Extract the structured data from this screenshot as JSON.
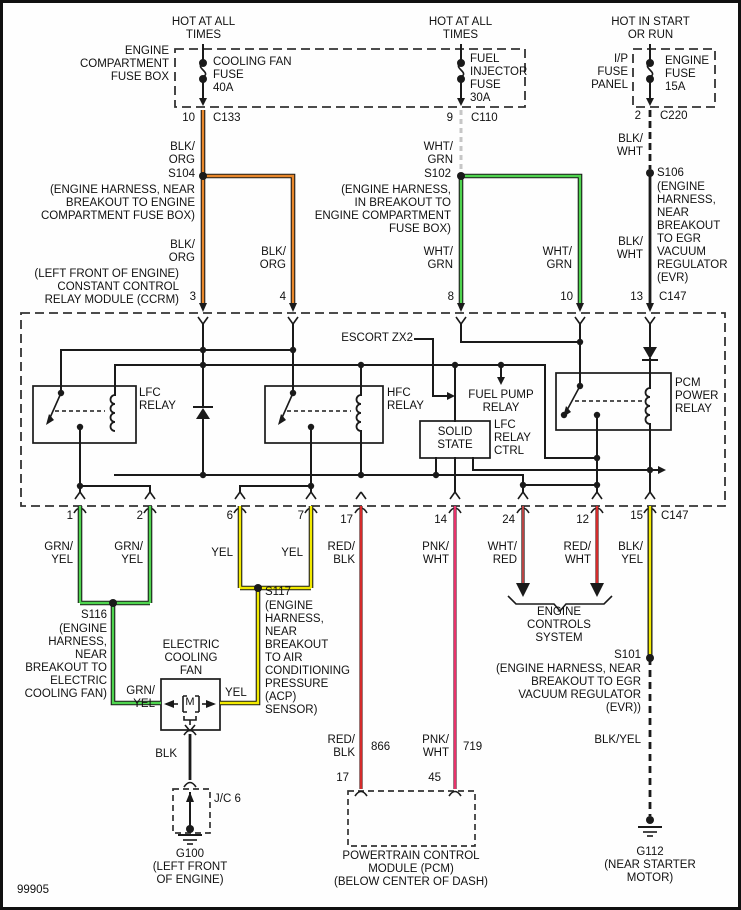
{
  "meta": {
    "footer_code": "99905"
  },
  "power": {
    "left": {
      "heading": "HOT AT ALL\nTIMES",
      "box": "ENGINE\nCOMPARTMENT\nFUSE BOX",
      "fuse": "COOLING FAN\nFUSE\n40A",
      "pin": "10",
      "conn": "C133"
    },
    "mid": {
      "heading": "HOT AT ALL\nTIMES",
      "fuse": "FUEL\nINJECTOR\nFUSE\n30A",
      "pin": "9",
      "conn": "C110"
    },
    "right": {
      "heading": "HOT IN START\nOR RUN",
      "box": "I/P\nFUSE\nPANEL",
      "fuse": "ENGINE\nFUSE\n15A",
      "pin": "2",
      "conn": "C220"
    }
  },
  "splices": {
    "s104": {
      "id": "S104",
      "desc": "(ENGINE HARNESS, NEAR\nBREAKOUT TO ENGINE\nCOMPARTMENT FUSE BOX)"
    },
    "s102": {
      "id": "S102",
      "desc": "(ENGINE HARNESS,\nIN BREAKOUT TO\nENGINE COMPARTMENT\nFUSE BOX)"
    },
    "s106": {
      "id": "S106",
      "desc": "(ENGINE\nHARNESS,\nNEAR\nBREAKOUT\nTO EGR\nVACUUM\nREGULATOR\n(EVR)"
    },
    "s116": {
      "id": "S116",
      "desc": "(ENGINE\nHARNESS,\nNEAR\nBREAKOUT TO\nELECTRIC\nCOOLING FAN)"
    },
    "s117": {
      "id": "S117",
      "desc": "(ENGINE\nHARNESS,\nNEAR\nBREAKOUT\nTO AIR\nCONDITIONING\nPRESSURE\n(ACP)\nSENSOR)"
    },
    "s101": {
      "id": "S101",
      "desc": "(ENGINE HARNESS, NEAR\nBREAKOUT TO EGR\nVACUUM REGULATOR\n(EVR))"
    }
  },
  "ccrm": {
    "label": "(LEFT FRONT OF ENGINE)\nCONSTANT CONTROL\nRELAY MODULE (CCRM)",
    "escort_note": "ESCORT ZX2",
    "solid_state": "SOLID\nSTATE",
    "lfc_ctrl": "LFC\nRELAY\nCTRL",
    "conn_top": "C147",
    "conn_bottom": "C147",
    "relays": {
      "lfc": "LFC\nRELAY",
      "hfc": "HFC\nRELAY",
      "fuel_pump": "FUEL PUMP\nRELAY",
      "pcm": "PCM\nPOWER\nRELAY"
    },
    "pins_top": {
      "p3": "3",
      "p4": "4",
      "p8": "8",
      "p10": "10",
      "p13": "13"
    },
    "pins_bottom": {
      "p1": "1",
      "p2": "2",
      "p6": "6",
      "p7": "7",
      "p17": "17",
      "p14": "14",
      "p24": "24",
      "p12": "12",
      "p15": "15"
    }
  },
  "wires": {
    "blk_org": "BLK/\nORG",
    "wht_grn": "WHT/\nGRN",
    "blk_wht": "BLK/\nWHT",
    "grn_yel": "GRN/\nYEL",
    "yel": "YEL",
    "red_blk": "RED/\nBLK",
    "pnk_wht": "PNK/\nWHT",
    "wht_red": "WHT/\nRED",
    "red_wht": "RED/\nWHT",
    "blk_yel": "BLK/\nYEL",
    "blk_yel_inline": "BLK/YEL",
    "blk": "BLK"
  },
  "circuits": {
    "c866": "866",
    "c719": "719"
  },
  "fan": {
    "label": "ELECTRIC\nCOOLING\nFAN",
    "motor": "M"
  },
  "grounds": {
    "jc6": "J/C 6",
    "g100": {
      "id": "G100",
      "desc": "(LEFT FRONT\nOF ENGINE)"
    },
    "g112": {
      "id": "G112",
      "desc": "(NEAR STARTER\nMOTOR)"
    }
  },
  "pcm": {
    "pin17": "17",
    "pin45": "45",
    "label": "POWERTRAIN CONTROL\nMODULE (PCM)\n(BELOW CENTER OF DASH)"
  },
  "engine_controls": "ENGINE\nCONTROLS\nSYSTEM",
  "colors": {
    "orange": "#E8872B",
    "green": "#4ED44E",
    "yellow": "#F2EA00",
    "red": "#D42B2B",
    "pink": "#E8326B",
    "thin_red": "#E05050",
    "gray": "#C6C6C6"
  }
}
